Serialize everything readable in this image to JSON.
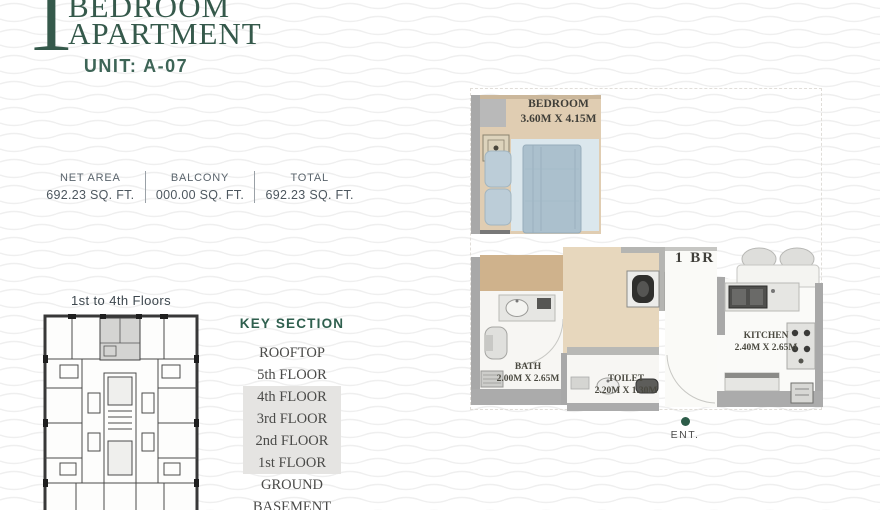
{
  "header": {
    "number": "1",
    "line1": "BEDROOM",
    "line2": "APARTMENT",
    "unit": "UNIT: A-07"
  },
  "stats": [
    {
      "label": "NET AREA",
      "value": "692.23 SQ. FT."
    },
    {
      "label": "BALCONY",
      "value": "000.00 SQ. FT."
    },
    {
      "label": "TOTAL",
      "value": "692.23 SQ. FT."
    }
  ],
  "key_plan": {
    "caption": "1st to 4th Floors"
  },
  "key_section": {
    "title": "KEY SECTION",
    "floors": [
      {
        "label": "ROOFTOP",
        "highlighted": false
      },
      {
        "label": "5th FLOOR",
        "highlighted": false
      },
      {
        "label": "4th FLOOR",
        "highlighted": true
      },
      {
        "label": "3rd FLOOR",
        "highlighted": true
      },
      {
        "label": "2nd FLOOR",
        "highlighted": true
      },
      {
        "label": "1st FLOOR",
        "highlighted": true
      },
      {
        "label": "GROUND",
        "highlighted": false
      },
      {
        "label": "BASEMENT",
        "highlighted": false
      }
    ]
  },
  "floor_plan": {
    "unit_type": "1 BR",
    "rooms": [
      {
        "name": "BEDROOM",
        "dimensions": "3.60M X 4.15M"
      },
      {
        "name": "BATH",
        "dimensions": "2.00M X 2.65M"
      },
      {
        "name": "TOILET",
        "dimensions": "2.20M X 1.30M"
      },
      {
        "name": "KITCHEN",
        "dimensions": "2.40M X 2.65M"
      }
    ],
    "entrance_label": "ENT."
  },
  "colors": {
    "brand_green": "#35594b",
    "unit_green": "#3e6557",
    "key_section_green": "#2f5f4e",
    "entrance_dot_green": "#2d5c49",
    "floor_highlight": "#e5e4e2",
    "plan_wall_gray": "#a8a8a8",
    "plan_floor_tan": "#e0cdb2",
    "hall_floor_tan": "#cfb28c",
    "bed_blue": "#abc0cd",
    "rug_blue": "#dbe7ed",
    "wave_line": "#efefef"
  }
}
